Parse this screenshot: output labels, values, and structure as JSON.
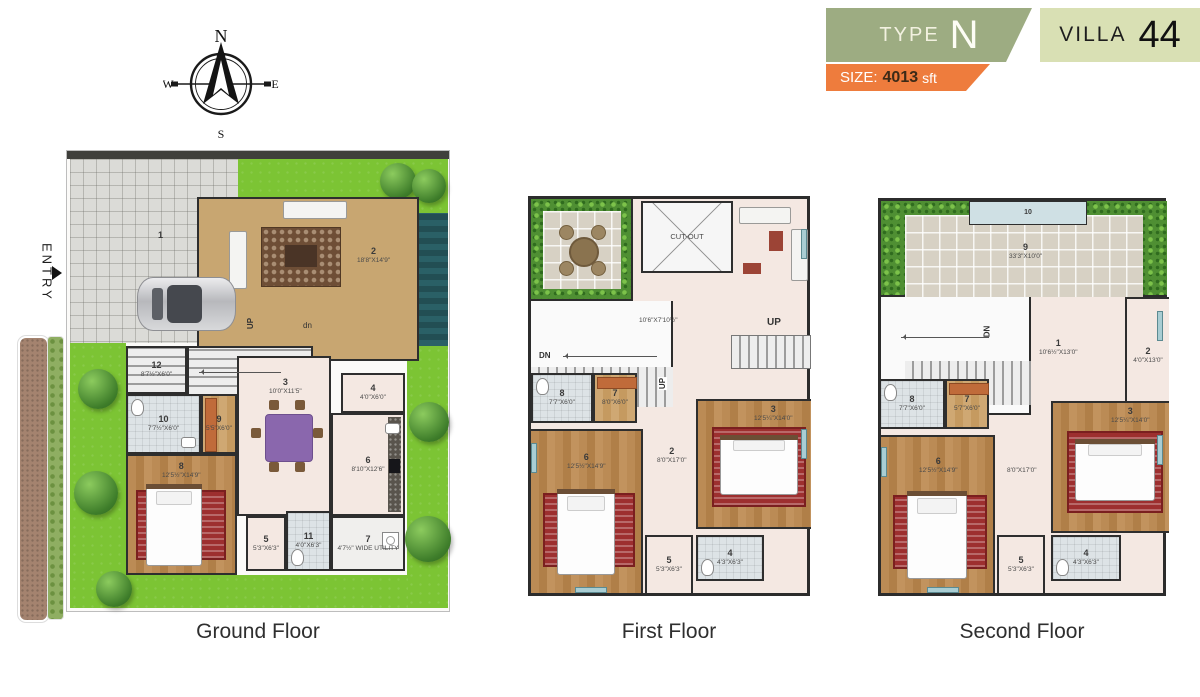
{
  "header": {
    "type_label": "TYPE",
    "type_value": "N",
    "villa_label": "VILLA",
    "villa_value": "44",
    "size_label": "SIZE:",
    "size_value": "4013",
    "size_unit": "sft",
    "colors": {
      "type_bg": "#9dac82",
      "villa_bg": "#d9e0b4",
      "size_bg": "#ee7c3d"
    }
  },
  "compass": {
    "n": "N",
    "e": "E",
    "s": "S",
    "w": "W"
  },
  "entry": {
    "label": "ENTRY"
  },
  "g": {
    "title": "Ground Floor",
    "up": "UP",
    "dn": "dn",
    "rooms": {
      "r1": {
        "n": "1",
        "d": ""
      },
      "r2": {
        "n": "2",
        "d": "18'8\"X14'9\""
      },
      "r3": {
        "n": "3",
        "d": "10'0\"X11'5\""
      },
      "r4": {
        "n": "4",
        "d": "4'0\"X6'0\""
      },
      "r5": {
        "n": "5",
        "d": "5'3\"X6'3\""
      },
      "r6": {
        "n": "6",
        "d": "8'10\"X12'6\""
      },
      "r7": {
        "n": "7",
        "d": "4'7½\" WIDE UTILITY"
      },
      "r8": {
        "n": "8",
        "d": "12'5½\"X14'9\""
      },
      "r9": {
        "n": "9",
        "d": "5'5\"X6'0\""
      },
      "r10": {
        "n": "10",
        "d": "7'7½\"X6'0\""
      },
      "r11": {
        "n": "11",
        "d": "4'0\"X6'3\""
      },
      "r12": {
        "n": "12",
        "d": "8'7½\"X6'0\""
      }
    }
  },
  "f1": {
    "title": "First Floor",
    "up": "UP",
    "dn": "DN",
    "cutout": "CUT-OUT",
    "lobby_d": "10'6\"X7'10½\"",
    "rooms": {
      "r2": {
        "n": "2",
        "d": "8'0\"X17'0\""
      },
      "r3": {
        "n": "3",
        "d": "12'5¼\"X14'0\""
      },
      "r4": {
        "n": "4",
        "d": "4'3\"X6'3\""
      },
      "r5": {
        "n": "5",
        "d": "5'3\"X6'3\""
      },
      "r6": {
        "n": "6",
        "d": "12'5½\"X14'9\""
      },
      "r7": {
        "n": "7",
        "d": "8'0\"X6'0\""
      },
      "r8": {
        "n": "8",
        "d": "7'7\"X6'0\""
      }
    }
  },
  "f2": {
    "title": "Second Floor",
    "dn": "DN",
    "corridor_d": "8'0\"X17'0\"",
    "rooms": {
      "r1": {
        "n": "1",
        "d": "10'6½\"X13'0\""
      },
      "r2": {
        "n": "2",
        "d": "4'0\"X13'0\""
      },
      "r3": {
        "n": "3",
        "d": "12'5¼\"X14'0\""
      },
      "r4": {
        "n": "4",
        "d": "4'3\"X6'3\""
      },
      "r5": {
        "n": "5",
        "d": "5'3\"X6'3\""
      },
      "r6": {
        "n": "6",
        "d": "12'5½\"X14'9\""
      },
      "r7": {
        "n": "7",
        "d": "5'7\"X6'0\""
      },
      "r8": {
        "n": "8",
        "d": "7'7\"X6'0\""
      },
      "r9": {
        "n": "9",
        "d": "33'3\"X10'0\""
      },
      "r10": {
        "n": "10",
        "d": ""
      }
    }
  }
}
